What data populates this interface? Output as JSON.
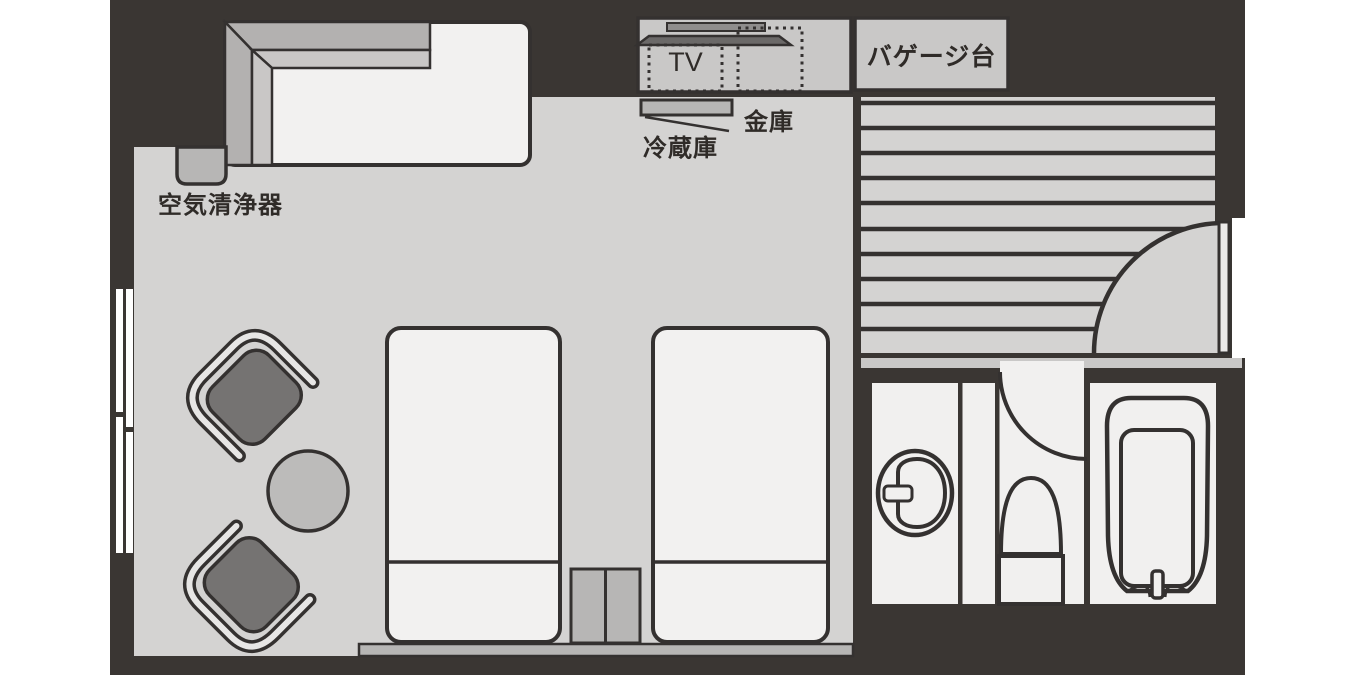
{
  "title": "hotel-twin-room-floor-plan",
  "labels": {
    "tv": "TV",
    "safe": "金庫",
    "refrigerator": "冷蔵庫",
    "baggage_stand": "バゲージ台",
    "air_purifier": "空気清浄器"
  },
  "colors": {
    "background": "#ffffff",
    "wall": "#3a3633",
    "outline": "#343130",
    "floor": "#d4d3d2",
    "bath_floor": "#f1f0ef",
    "bed": "#f2f1f0",
    "cabinet": "#c9c8c7",
    "furniture_mid": "#b7b6b5",
    "tv_screen": "#6b6968",
    "tv_stand": "#8f8d8c",
    "chair_seat": "#757372",
    "chair_band": "#e7e6e5",
    "table": "#bcbbba",
    "step": "#c9c8c7",
    "door": "#eae9e8",
    "band_outer": "#b3b1b0",
    "band_inner": "#c9c7c6",
    "text": "#2f2b28"
  }
}
